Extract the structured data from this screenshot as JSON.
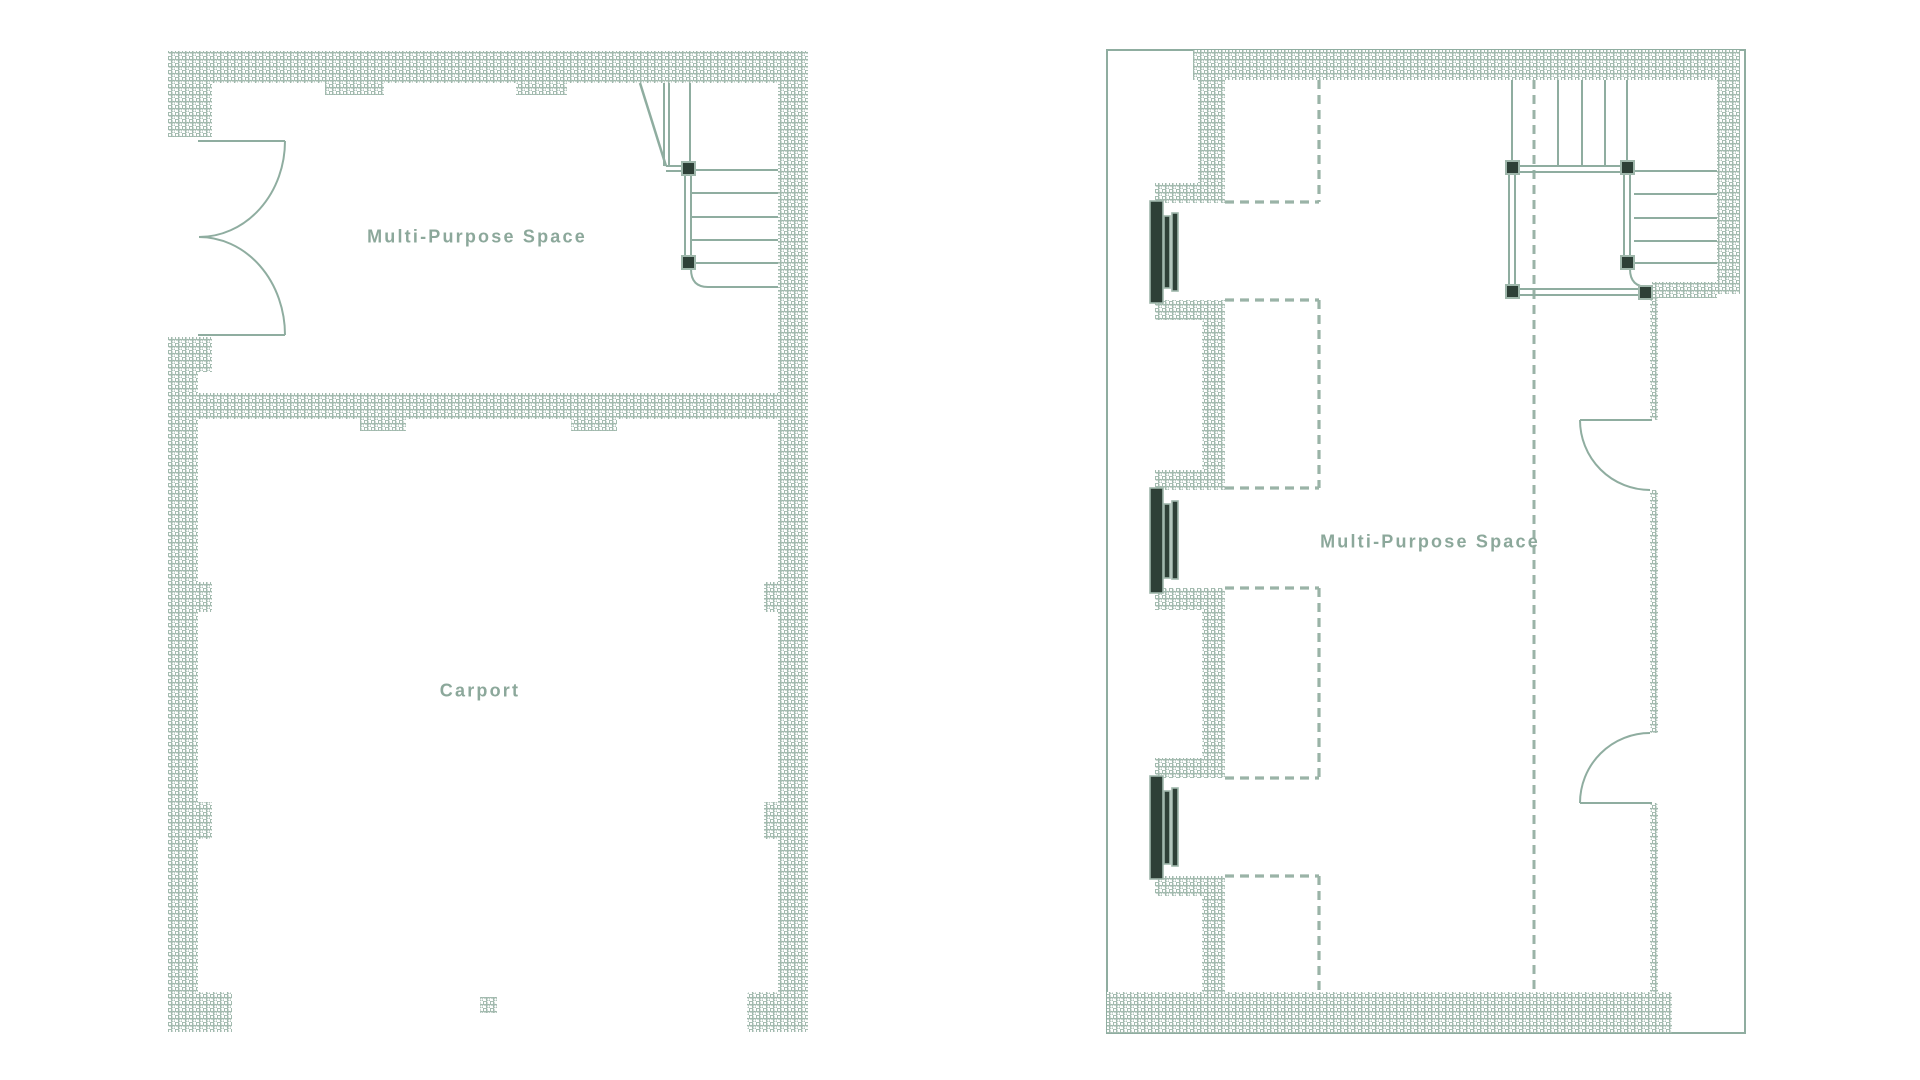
{
  "page": {
    "title": "Floor Plans",
    "background": "#ffffff"
  },
  "palette": {
    "wall_hatch": "#9db6aa",
    "line": "#8fada0",
    "dash_line": "#9ab3a7",
    "label_text": "#8ca89b",
    "dark_frame": "#2e4037"
  },
  "plans": {
    "left": {
      "name": "Ground floor plan",
      "rooms": [
        {
          "label": "Multi-Purpose Space"
        },
        {
          "label": "Carport"
        }
      ]
    },
    "right": {
      "name": "Upper floor plan",
      "rooms": [
        {
          "label": "Multi-Purpose Space"
        }
      ]
    }
  }
}
